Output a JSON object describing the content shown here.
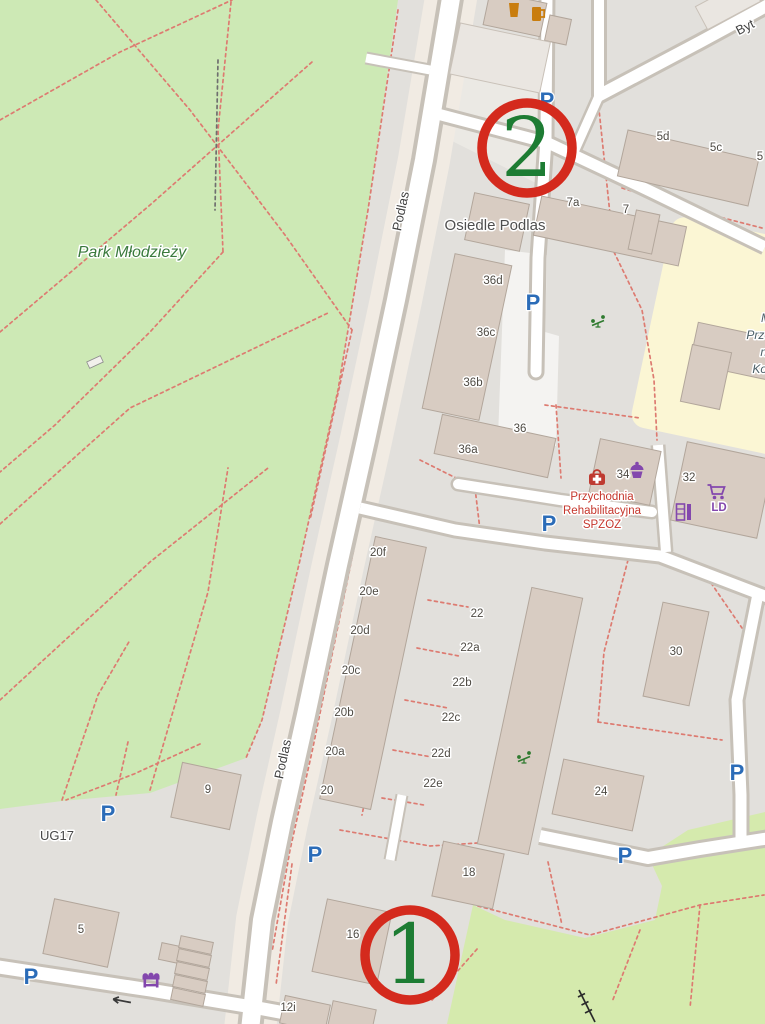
{
  "map": {
    "size": {
      "w": 765,
      "h": 1024
    },
    "colors": {
      "base": "#e2e0dc",
      "park": "#cde9b5",
      "grass": "#d5eaad",
      "school_yard": "#fbf6d4",
      "building": "#d8ccc2",
      "building_stroke": "#b2a69b",
      "building_light": "#eae6e1",
      "road_fill": "#ffffff",
      "road_casing": "#c7c1b8",
      "corridor": "#f1ebe3",
      "parking_lot": "#ebe9e4",
      "pedestrian": "#f4f3f1",
      "path_dash": "#dd7b71",
      "annotation_ring": "#d42a1d",
      "annotation_number": "#1d7c33",
      "parking_blue": "#2b6cb8",
      "shop_purple": "#8347ad",
      "health_red": "#bf3a30",
      "food_orange": "#c97d0e",
      "playground_green": "#2f7a2f",
      "label_dark": "#4e4a43",
      "street_gray": "#3f3f3f",
      "park_label": "#3a7a3c",
      "clinic_red": "#c5362c",
      "school_label": "#4a5e66"
    },
    "areas": [
      {
        "name": "park-mlodziezy",
        "type": "poly",
        "fill": "park",
        "pts": "0,0 398,0 368,210 338,390 300,560 262,720 246,758 150,793 62,801 0,809"
      },
      {
        "name": "grass-southeast",
        "type": "poly",
        "fill": "grass",
        "pts": "765,812 688,830 648,856 662,886 655,920 585,938 505,920 473,905 447,1024 765,1024"
      },
      {
        "name": "yard-wedge",
        "type": "poly",
        "fill": "base",
        "pts": "540,860 650,862 646,915 562,928 540,898"
      },
      {
        "name": "school-yard",
        "type": "rrect",
        "fill": "school_yard",
        "cx": 737,
        "cy": 338,
        "w": 175,
        "h": 215,
        "rot": 12,
        "rx": 14
      },
      {
        "name": "parking-lot-north",
        "type": "poly",
        "fill": "parking_lot",
        "pts": "432,60 545,60 540,185 430,130"
      },
      {
        "name": "pedestrian-area",
        "type": "poly",
        "fill": "pedestrian",
        "pts": "505,250 547,255 545,332 559,336 556,446 498,438 502,330"
      }
    ],
    "corridor": {
      "name": "podlas-corridor",
      "width": 52,
      "pts": [
        [
          452,
          -8
        ],
        [
          424,
          160
        ],
        [
          396,
          300
        ],
        [
          366,
          440
        ],
        [
          338,
          565
        ],
        [
          306,
          715
        ],
        [
          282,
          822
        ],
        [
          262,
          920
        ],
        [
          250,
          1030
        ]
      ]
    },
    "roads": [
      {
        "name": "road-podlas",
        "w": 18,
        "cas": 26,
        "pts": [
          [
            452,
            -8
          ],
          [
            424,
            160
          ],
          [
            396,
            300
          ],
          [
            366,
            440
          ],
          [
            338,
            565
          ],
          [
            306,
            715
          ],
          [
            282,
            822
          ],
          [
            262,
            920
          ],
          [
            250,
            1030
          ]
        ]
      },
      {
        "name": "road-top-stub",
        "w": 11,
        "cas": 17,
        "pts": [
          [
            430,
            112
          ],
          [
            548,
            143
          ]
        ]
      },
      {
        "name": "road-park-stub",
        "w": 9,
        "cas": 13,
        "pts": [
          [
            430,
            70
          ],
          [
            366,
            58
          ]
        ]
      },
      {
        "name": "road-north-lane",
        "w": 11,
        "cas": 17,
        "cap": "round",
        "pts": [
          [
            547,
            -8
          ],
          [
            546,
            140
          ],
          [
            538,
            258
          ],
          [
            536,
            372
          ]
        ]
      },
      {
        "name": "road-northeast",
        "w": 11,
        "cas": 17,
        "pts": [
          [
            546,
            142
          ],
          [
            652,
            192
          ],
          [
            765,
            247
          ]
        ]
      },
      {
        "name": "road-bytomska",
        "w": 12,
        "cas": 18,
        "pts": [
          [
            598,
            96
          ],
          [
            700,
            42
          ],
          [
            770,
            4
          ]
        ]
      },
      {
        "name": "road-byt-stub",
        "w": 10,
        "cas": 16,
        "pts": [
          [
            599,
            -8
          ],
          [
            599,
            96
          ]
        ]
      },
      {
        "name": "road-byt-conn",
        "w": 9,
        "cas": 14,
        "pts": [
          [
            599,
            96
          ],
          [
            574,
            152
          ]
        ]
      },
      {
        "name": "road-clinic-deadend",
        "w": 10,
        "cas": 15,
        "cap": "round",
        "pts": [
          [
            458,
            484
          ],
          [
            560,
            500
          ],
          [
            652,
            512
          ]
        ]
      },
      {
        "name": "road-mid",
        "w": 11,
        "cas": 17,
        "pts": [
          [
            360,
            508
          ],
          [
            455,
            530
          ],
          [
            545,
            543
          ],
          [
            660,
            556
          ],
          [
            770,
            598
          ]
        ]
      },
      {
        "name": "road-clinic-lane",
        "w": 10,
        "cas": 15,
        "pts": [
          [
            658,
            445
          ],
          [
            666,
            552
          ]
        ]
      },
      {
        "name": "road-east-lane",
        "w": 11,
        "cas": 17,
        "pts": [
          [
            758,
            594
          ],
          [
            737,
            700
          ],
          [
            741,
            795
          ],
          [
            741,
            842
          ]
        ]
      },
      {
        "name": "road-southeast",
        "w": 12,
        "cas": 18,
        "pts": [
          [
            540,
            836
          ],
          [
            648,
            858
          ],
          [
            700,
            849
          ],
          [
            770,
            838
          ]
        ]
      },
      {
        "name": "road-south",
        "w": 13,
        "cas": 19,
        "pts": [
          [
            -8,
            966
          ],
          [
            150,
            990
          ],
          [
            258,
            1008
          ],
          [
            312,
            1018
          ]
        ]
      },
      {
        "name": "road-estate-stub",
        "w": 9,
        "cas": 13,
        "pts": [
          [
            402,
            795
          ],
          [
            390,
            860
          ]
        ]
      }
    ],
    "paths": [
      {
        "d": "M96,0 L190,110 L285,235 L352,330"
      },
      {
        "d": "M0,120 L120,52 L232,0"
      },
      {
        "d": "M0,332 L150,205 L312,62"
      },
      {
        "d": "M231,2 L218,130 L223,252"
      },
      {
        "d": "M223,252 L150,332 L55,425 L0,472"
      },
      {
        "d": "M0,524 L130,408 L330,312"
      },
      {
        "d": "M0,700 L150,562 L268,468"
      },
      {
        "d": "M150,790 L208,592 L228,468"
      },
      {
        "d": "M62,800 L98,695 L130,640"
      },
      {
        "d": "M398,10 L368,210 L338,390 L300,560 L262,720 L246,758"
      },
      {
        "d": "M352,330 L310,520"
      },
      {
        "d": "M218,60 L215,210",
        "color": "#6f6f6f"
      },
      {
        "d": "M455,28 L428,165 L396,340 L352,558 L312,752 L290,850 L272,952"
      },
      {
        "d": "M598,100 L614,252"
      },
      {
        "d": "M614,252 L642,310 L654,380 L657,440"
      },
      {
        "d": "M622,188 L700,212 L762,228"
      },
      {
        "d": "M545,405 L640,418"
      },
      {
        "d": "M556,405 L561,478"
      },
      {
        "d": "M420,460 L472,486"
      },
      {
        "d": "M475,488 L481,538"
      },
      {
        "d": "M420,548 L396,650 L374,755 L362,815"
      },
      {
        "d": "M428,600 L468,607"
      },
      {
        "d": "M417,648 L459,656"
      },
      {
        "d": "M405,700 L448,708"
      },
      {
        "d": "M393,750 L437,758"
      },
      {
        "d": "M382,798 L424,805"
      },
      {
        "d": "M628,560 L604,652 L598,722"
      },
      {
        "d": "M598,722 L722,740"
      },
      {
        "d": "M700,567 L742,628"
      },
      {
        "d": "M340,830 L430,846 L525,840"
      },
      {
        "d": "M292,864 L276,985"
      },
      {
        "d": "M548,862 L562,925"
      },
      {
        "d": "M128,742 L116,795"
      },
      {
        "d": "M200,744 L134,774 L66,800"
      },
      {
        "d": "M432,1000 L478,948"
      },
      {
        "d": "M478,906 L590,935 L700,905 L764,895"
      },
      {
        "d": "M640,930 L612,1002"
      },
      {
        "d": "M700,905 L690,1008"
      }
    ],
    "buildings": [
      {
        "cx": 515,
        "cy": 14,
        "w": 58,
        "h": 34,
        "rot": 12
      },
      {
        "cx": 558,
        "cy": 30,
        "w": 22,
        "h": 26,
        "rot": 12
      },
      {
        "cx": 500,
        "cy": 58,
        "w": 92,
        "h": 52,
        "rot": 12,
        "variant": "light"
      },
      {
        "cx": 728,
        "cy": 4,
        "w": 60,
        "h": 26,
        "rot": -28,
        "variant": "light"
      },
      {
        "cx": 688,
        "cy": 168,
        "w": 134,
        "h": 47,
        "rot": 13
      },
      {
        "cx": 610,
        "cy": 231,
        "w": 148,
        "h": 40,
        "rot": 12
      },
      {
        "cx": 497,
        "cy": 222,
        "w": 56,
        "h": 48,
        "rot": 12
      },
      {
        "cx": 644,
        "cy": 232,
        "w": 24,
        "h": 40,
        "rot": 12
      },
      {
        "cx": 467,
        "cy": 337,
        "w": 58,
        "h": 158,
        "rot": 12
      },
      {
        "cx": 495,
        "cy": 446,
        "w": 116,
        "h": 40,
        "rot": 12
      },
      {
        "cx": 625,
        "cy": 472,
        "w": 62,
        "h": 55,
        "rot": 12
      },
      {
        "cx": 722,
        "cy": 490,
        "w": 88,
        "h": 80,
        "rot": 12
      },
      {
        "cx": 737,
        "cy": 352,
        "w": 88,
        "h": 42,
        "rot": 12
      },
      {
        "cx": 706,
        "cy": 377,
        "w": 40,
        "h": 58,
        "rot": 12
      },
      {
        "cx": 373,
        "cy": 673,
        "w": 52,
        "h": 268,
        "rot": 12
      },
      {
        "cx": 530,
        "cy": 721,
        "w": 52,
        "h": 262,
        "rot": 12
      },
      {
        "cx": 676,
        "cy": 654,
        "w": 47,
        "h": 96,
        "rot": 12
      },
      {
        "cx": 598,
        "cy": 795,
        "w": 82,
        "h": 56,
        "rot": 12
      },
      {
        "cx": 468,
        "cy": 875,
        "w": 62,
        "h": 56,
        "rot": 12
      },
      {
        "cx": 352,
        "cy": 942,
        "w": 66,
        "h": 74,
        "rot": 12
      },
      {
        "cx": 305,
        "cy": 1014,
        "w": 46,
        "h": 28,
        "rot": 12
      },
      {
        "cx": 352,
        "cy": 1018,
        "w": 44,
        "h": 26,
        "rot": 12
      },
      {
        "cx": 206,
        "cy": 796,
        "w": 60,
        "h": 56,
        "rot": 12
      },
      {
        "cx": 81,
        "cy": 933,
        "w": 66,
        "h": 56,
        "rot": 12
      },
      {
        "cx": 170,
        "cy": 953,
        "w": 20,
        "h": 17,
        "rot": 12
      },
      {
        "cx": 196,
        "cy": 945,
        "w": 33,
        "h": 12,
        "rot": 12
      },
      {
        "cx": 194,
        "cy": 958,
        "w": 33,
        "h": 12,
        "rot": 12
      },
      {
        "cx": 192,
        "cy": 971,
        "w": 33,
        "h": 12,
        "rot": 12
      },
      {
        "cx": 190,
        "cy": 984,
        "w": 33,
        "h": 12,
        "rot": 12
      },
      {
        "cx": 188,
        "cy": 997,
        "w": 33,
        "h": 12,
        "rot": 12
      }
    ],
    "street_labels": [
      {
        "text": "Podlas",
        "x": 405,
        "y": 212,
        "rot": -78,
        "size": 13
      },
      {
        "text": "Podlas",
        "x": 287,
        "y": 760,
        "rot": -78,
        "size": 13
      },
      {
        "text": "Byt",
        "x": 747,
        "y": 31,
        "rot": -27,
        "size": 13
      }
    ],
    "place_labels": [
      {
        "text": "Park Młodzieży",
        "x": 132,
        "y": 257,
        "size": 16,
        "color": "park_label",
        "italic": true
      },
      {
        "text": "Osiedle Podlas",
        "x": 495,
        "y": 230,
        "size": 15,
        "color": "#4f4f4f"
      },
      {
        "text": "UG17",
        "x": 57,
        "y": 840,
        "size": 13,
        "color": "#474747"
      }
    ],
    "clinic_label": {
      "lines": [
        "Przychodnia",
        "Rehabilitacyjna",
        "SPZOZ"
      ],
      "x": 602,
      "ys": [
        500,
        514,
        528
      ],
      "size": 11.5
    },
    "school_label": {
      "lines": [
        "M",
        "Prze",
        "nr",
        "Kor"
      ],
      "x": 771,
      "ys": [
        322,
        339,
        356,
        373
      ],
      "size": 12
    },
    "building_labels": [
      {
        "text": "5d",
        "x": 663,
        "y": 140
      },
      {
        "text": "5c",
        "x": 716,
        "y": 151
      },
      {
        "text": "5",
        "x": 760,
        "y": 160
      },
      {
        "text": "7a",
        "x": 573,
        "y": 206
      },
      {
        "text": "7",
        "x": 626,
        "y": 213
      },
      {
        "text": "36d",
        "x": 493,
        "y": 284
      },
      {
        "text": "36c",
        "x": 486,
        "y": 336
      },
      {
        "text": "36b",
        "x": 473,
        "y": 386
      },
      {
        "text": "36",
        "x": 520,
        "y": 432
      },
      {
        "text": "36a",
        "x": 468,
        "y": 453
      },
      {
        "text": "34",
        "x": 623,
        "y": 478
      },
      {
        "text": "32",
        "x": 689,
        "y": 481
      },
      {
        "text": "20f",
        "x": 378,
        "y": 556
      },
      {
        "text": "20e",
        "x": 369,
        "y": 595
      },
      {
        "text": "20d",
        "x": 360,
        "y": 634
      },
      {
        "text": "20c",
        "x": 351,
        "y": 674
      },
      {
        "text": "20b",
        "x": 344,
        "y": 716
      },
      {
        "text": "20a",
        "x": 335,
        "y": 755
      },
      {
        "text": "20",
        "x": 327,
        "y": 794
      },
      {
        "text": "22",
        "x": 477,
        "y": 617
      },
      {
        "text": "22a",
        "x": 470,
        "y": 651
      },
      {
        "text": "22b",
        "x": 462,
        "y": 686
      },
      {
        "text": "22c",
        "x": 451,
        "y": 721
      },
      {
        "text": "22d",
        "x": 441,
        "y": 757
      },
      {
        "text": "22e",
        "x": 433,
        "y": 787
      },
      {
        "text": "30",
        "x": 676,
        "y": 655
      },
      {
        "text": "24",
        "x": 601,
        "y": 795
      },
      {
        "text": "18",
        "x": 469,
        "y": 876
      },
      {
        "text": "16",
        "x": 353,
        "y": 938
      },
      {
        "text": "12i",
        "x": 288,
        "y": 1011
      },
      {
        "text": "9",
        "x": 208,
        "y": 793
      },
      {
        "text": "5",
        "x": 81,
        "y": 933
      }
    ],
    "shop_text_label": {
      "text": "LD",
      "x": 719,
      "y": 511
    },
    "parking": [
      {
        "x": 547,
        "y": 101
      },
      {
        "x": 533,
        "y": 303
      },
      {
        "x": 549,
        "y": 524
      },
      {
        "x": 737,
        "y": 773
      },
      {
        "x": 625,
        "y": 856
      },
      {
        "x": 315,
        "y": 855
      },
      {
        "x": 108,
        "y": 814
      },
      {
        "x": 31,
        "y": 977
      }
    ],
    "icons": [
      {
        "type": "cup",
        "x": 514,
        "y": 10
      },
      {
        "type": "beer",
        "x": 537,
        "y": 14
      },
      {
        "type": "medical",
        "x": 597,
        "y": 479
      },
      {
        "type": "cupcake",
        "x": 637,
        "y": 470
      },
      {
        "type": "cart",
        "x": 716,
        "y": 491
      },
      {
        "type": "doors",
        "x": 684,
        "y": 512
      },
      {
        "type": "market",
        "x": 151,
        "y": 979
      },
      {
        "type": "playground",
        "x": 598,
        "y": 322
      },
      {
        "type": "playground",
        "x": 524,
        "y": 758
      },
      {
        "type": "power-line",
        "x": 588,
        "y": 1006
      },
      {
        "type": "arrow-left",
        "x": 121,
        "y": 1001
      }
    ],
    "misc": [
      {
        "type": "rect",
        "x": 95,
        "y": 362,
        "w": 15,
        "h": 7,
        "rot": -25,
        "fill": "#f2f0ec",
        "stroke": "#8d8d8d"
      }
    ],
    "annotations": [
      {
        "label": "2",
        "x": 527,
        "y": 148,
        "r": 45
      },
      {
        "label": "1",
        "x": 410,
        "y": 955,
        "r": 45
      }
    ]
  }
}
